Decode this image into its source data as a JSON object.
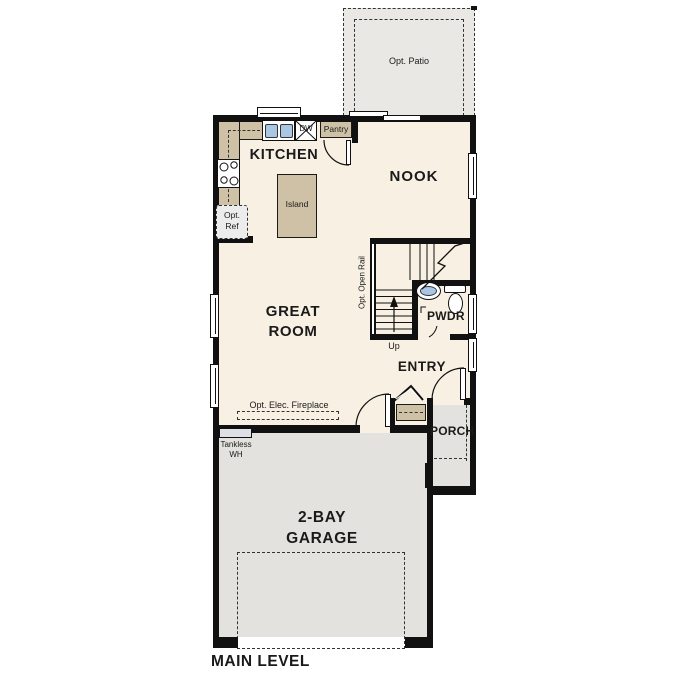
{
  "plan": {
    "title": "MAIN LEVEL",
    "patio": {
      "label": "Opt. Patio"
    },
    "kitchen": {
      "label": "KITCHEN",
      "pantry": "Pantry",
      "dishwasher": "DW",
      "island": "Island",
      "opt_ref": [
        "Opt.",
        "Ref"
      ]
    },
    "nook": {
      "label": "NOOK"
    },
    "great_room": {
      "label": [
        "GREAT",
        "ROOM"
      ],
      "fireplace": "Opt. Elec. Fireplace"
    },
    "stairs": {
      "rail": "Opt. Open Rail",
      "up": "Up"
    },
    "pwdr": {
      "label": "PWDR"
    },
    "entry": {
      "label": "ENTRY"
    },
    "porch": {
      "label": "PORCH"
    },
    "garage": {
      "label": [
        "2-BAY",
        "GARAGE"
      ],
      "tankless": [
        "Tankless",
        "WH"
      ]
    },
    "colors": {
      "floor": "#f7f0e3",
      "garage": "#e3e2de",
      "patio": "#e9e8e4",
      "counter": "#cec1a5",
      "fixture_blue": "#a9c7e5",
      "wall": "#111111"
    }
  }
}
